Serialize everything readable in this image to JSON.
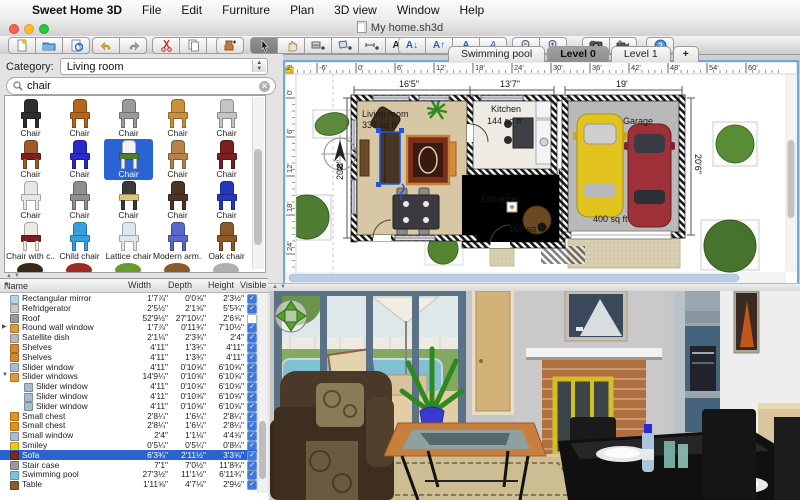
{
  "menu_bar": {
    "apple_icon": "apple-logo",
    "app_name": "Sweet Home 3D",
    "items": [
      "File",
      "Edit",
      "Furniture",
      "Plan",
      "3D view",
      "Window",
      "Help"
    ]
  },
  "title_bar": {
    "title": "My home.sh3d",
    "window_controls": [
      "close-button",
      "minimize-button",
      "zoom-button"
    ]
  },
  "toolbar": {
    "icons": [
      "new-document",
      "open-folder",
      "save",
      "undo",
      "redo",
      "cut",
      "copy",
      "paste",
      "add-furniture",
      "select-pointer",
      "pan-hand",
      "create-walls",
      "create-rooms",
      "create-dimensions",
      "add-text",
      "decrease-text-size",
      "increase-text-size",
      "bold",
      "italic",
      "zoom-out",
      "zoom-in",
      "create-photo",
      "create-video",
      "help"
    ]
  },
  "catalog": {
    "category_label": "Category:",
    "category_value": "Living room",
    "search_value": "chair",
    "items": [
      {
        "label": "Chair",
        "color": "#2e2e2e"
      },
      {
        "label": "Chair",
        "color": "#b5651d"
      },
      {
        "label": "Chair",
        "color": "#9a9a9a"
      },
      {
        "label": "Chair",
        "color": "#c8913a"
      },
      {
        "label": "Chair",
        "color": "#c4c4c4"
      },
      {
        "label": "Chair",
        "color": "#a05a2a",
        "seat": "#7c1f1f"
      },
      {
        "label": "Chair",
        "color": "#2a2acc"
      },
      {
        "label": "Chair",
        "color": "#f2f2ee",
        "seat": "#4e7e2a",
        "selected": true
      },
      {
        "label": "Chair",
        "color": "#b5824a"
      },
      {
        "label": "Chair",
        "color": "#7c1f1f"
      },
      {
        "label": "Chair",
        "color": "#e6e6e2"
      },
      {
        "label": "Chair",
        "color": "#8f8f8f"
      },
      {
        "label": "Chair",
        "color": "#3a3a3a",
        "seat": "#d8c87a"
      },
      {
        "label": "Chair",
        "color": "#4e3423"
      },
      {
        "label": "Chair",
        "color": "#2438bd"
      },
      {
        "label": "Chair with c...",
        "color": "#efe9e4",
        "seat": "#7c1f1f"
      },
      {
        "label": "Child chair",
        "color": "#35a0dd"
      },
      {
        "label": "Lattice chair",
        "color": "#dfe6ef"
      },
      {
        "label": "Modern arm...",
        "color": "#5a68cc"
      },
      {
        "label": "Oak chair",
        "color": "#8a5a2b"
      }
    ],
    "partial_row_colors": [
      "#3a2817",
      "#9e2b25",
      "#6a9a2f",
      "#8a5a2b",
      "#b0b0b0"
    ]
  },
  "furniture_table": {
    "headers": [
      "Name",
      "Width",
      "Depth",
      "Height",
      "Visible"
    ],
    "sort_icon": "sort-ascending-icon",
    "rows": [
      {
        "name": "Rectangular mirror",
        "width": "1'7⅞\"",
        "depth": "0'0⅝\"",
        "height": "2'3½\"",
        "visible": true,
        "icon": "mirror-icon",
        "color": "#b8d4e8"
      },
      {
        "name": "Refridgerator",
        "width": "2'5½\"",
        "depth": "2'1⅝\"",
        "height": "5'5¾\"",
        "visible": true,
        "icon": "fridge-icon",
        "color": "#c9c9c9"
      },
      {
        "name": "Roof",
        "width": "52'9½\"",
        "depth": "27'10¼\"",
        "height": "2'6⅝\"",
        "visible": false,
        "icon": "roof-icon",
        "color": "#9a9a9a"
      },
      {
        "name": "Round wall window",
        "width": "1'7⅞\"",
        "depth": "0'11¾\"",
        "height": "7'10½\"",
        "visible": true,
        "icon": "window-icon",
        "color": "#e09a3a",
        "expander": "closed"
      },
      {
        "name": "Satellite dish",
        "width": "2'1⅛\"",
        "depth": "2'3¾\"",
        "height": "2'4\"",
        "visible": true,
        "icon": "satellite-dish-icon",
        "color": "#b8b8b8"
      },
      {
        "name": "Shelves",
        "width": "4'11\"",
        "depth": "1'3¾\"",
        "height": "4'11\"",
        "visible": true,
        "icon": "shelves-icon",
        "color": "#d8882a"
      },
      {
        "name": "Shelves",
        "width": "4'11\"",
        "depth": "1'3¾\"",
        "height": "4'11\"",
        "visible": true,
        "icon": "shelves-icon",
        "color": "#d8882a"
      },
      {
        "name": "Slider window",
        "width": "4'11\"",
        "depth": "0'10⅝\"",
        "height": "6'10⅝\"",
        "visible": true,
        "icon": "window-icon",
        "color": "#a8bccd"
      },
      {
        "name": "Slider windows",
        "width": "14'9¼\"",
        "depth": "0'10⅝\"",
        "height": "6'10⅝\"",
        "visible": true,
        "icon": "window-group-icon",
        "color": "#e09a3a",
        "expander": "open"
      },
      {
        "name": "Slider window",
        "width": "4'11\"",
        "depth": "0'10⅝\"",
        "height": "6'10⅝\"",
        "visible": true,
        "icon": "window-icon",
        "color": "#a8bccd",
        "indent": true
      },
      {
        "name": "Slider window",
        "width": "4'11\"",
        "depth": "0'10⅝\"",
        "height": "6'10⅝\"",
        "visible": true,
        "icon": "window-icon",
        "color": "#a8bccd",
        "indent": true
      },
      {
        "name": "Slider window",
        "width": "4'11\"",
        "depth": "0'10⅝\"",
        "height": "6'10⅝\"",
        "visible": true,
        "icon": "window-icon",
        "color": "#a8bccd",
        "indent": true
      },
      {
        "name": "Small chest",
        "width": "2'8¼\"",
        "depth": "1'6¼\"",
        "height": "2'8¼\"",
        "visible": true,
        "icon": "chest-icon",
        "color": "#e89018"
      },
      {
        "name": "Small chest",
        "width": "2'8¼\"",
        "depth": "1'6¼\"",
        "height": "2'8¼\"",
        "visible": true,
        "icon": "chest-icon",
        "color": "#e89018"
      },
      {
        "name": "Small window",
        "width": "2'4\"",
        "depth": "1'1⅛\"",
        "height": "4'4⅝\"",
        "visible": true,
        "icon": "window-icon",
        "color": "#a8bccd"
      },
      {
        "name": "Smiley",
        "width": "0'5¼\"",
        "depth": "0'5¼\"",
        "height": "0'8¼\"",
        "visible": true,
        "icon": "smiley-icon",
        "color": "#ecc916"
      },
      {
        "name": "Sofa",
        "width": "6'3¾\"",
        "depth": "2'11½\"",
        "height": "3'3⅝\"",
        "visible": true,
        "icon": "sofa-icon",
        "color": "#7a2a20",
        "selected": true
      },
      {
        "name": "Stair case",
        "width": "7'1\"",
        "depth": "7'0½\"",
        "height": "11'8¾\"",
        "visible": true,
        "icon": "staircase-icon",
        "color": "#9a9a9a"
      },
      {
        "name": "Swimming pool",
        "width": "27'3½\"",
        "depth": "11'1½\"",
        "height": "6'11¾\"",
        "visible": true,
        "icon": "pool-icon",
        "color": "#7ec4de"
      },
      {
        "name": "Table",
        "width": "1'11⅝\"",
        "depth": "4'7⅛\"",
        "height": "2'9½\"",
        "visible": true,
        "icon": "table-icon",
        "color": "#8a5a30"
      }
    ]
  },
  "plan": {
    "tabs": [
      "Swimming pool",
      "Level 0",
      "Level 1",
      "+"
    ],
    "selected_tab": "Level 0",
    "h_ruler": [
      "-12'",
      "-6'",
      "0'",
      "6'",
      "12'",
      "18'",
      "24'",
      "30'",
      "36'",
      "42'",
      "48'",
      "54'",
      "60'"
    ],
    "v_ruler": [
      "0'",
      "6'",
      "12'",
      "18'",
      "24'"
    ],
    "rooms": [
      {
        "name": "Living room",
        "area": "339 sq ft"
      },
      {
        "name": "Kitchen",
        "area": "144 sq ft"
      },
      {
        "name": "Entrance",
        "area": "169 sq ft"
      },
      {
        "name": "Garage",
        "area": "400 sq ft"
      }
    ],
    "dimensions": {
      "living_width": "16'5\"",
      "kitchen_width": "13'7\"",
      "garage_width": "19'",
      "left_depth": "20'6\"",
      "right_depth": "20'6\""
    },
    "compass_label": "N",
    "selection_color": "#2255dd"
  },
  "view3d": {
    "navigation_icon": "navigation-arrows-icon"
  }
}
